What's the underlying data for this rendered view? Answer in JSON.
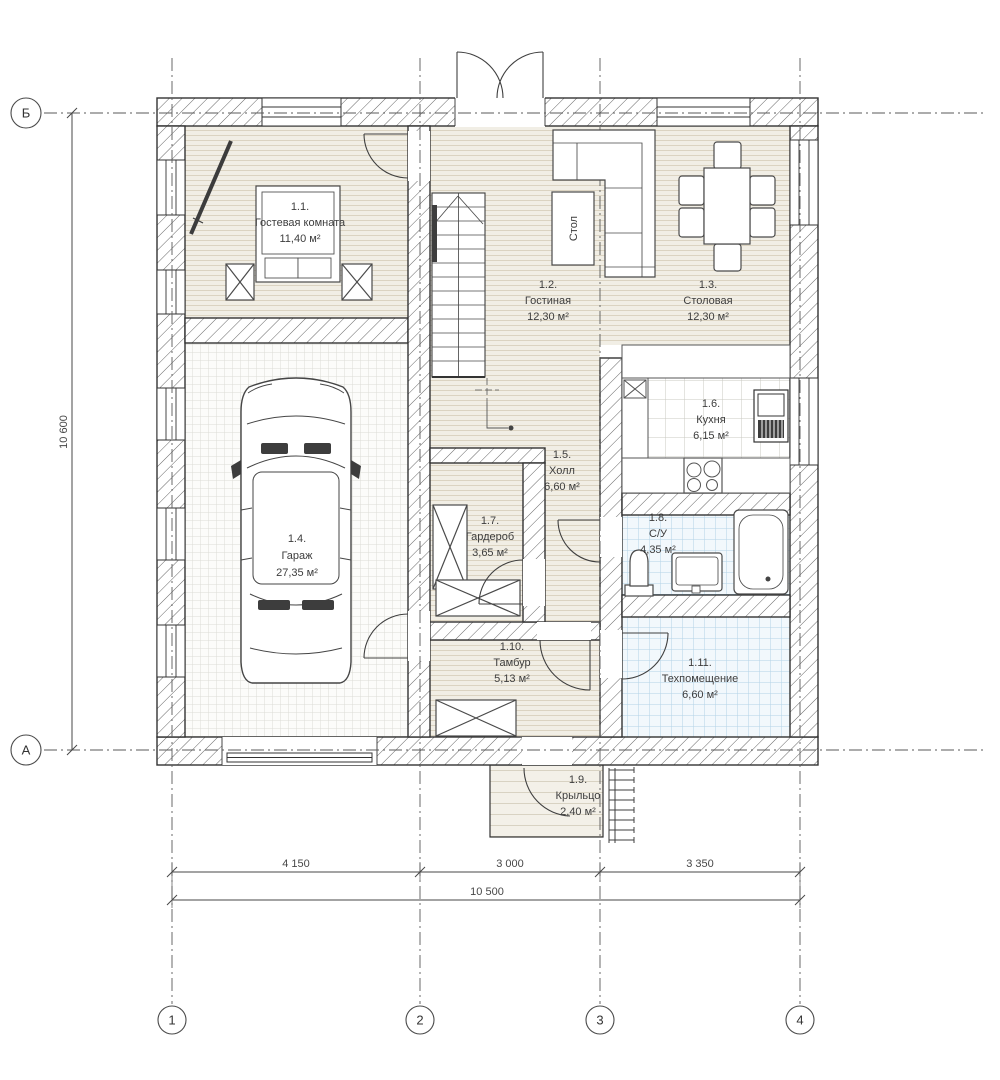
{
  "plan": {
    "rooms": [
      {
        "number": "1.1.",
        "name": "Гостевая комната",
        "area": "11,40 м²"
      },
      {
        "number": "1.2.",
        "name": "Гостиная",
        "area": "12,30 м²"
      },
      {
        "number": "1.3.",
        "name": "Столовая",
        "area": "12,30 м²"
      },
      {
        "number": "1.4.",
        "name": "Гараж",
        "area": "27,35 м²"
      },
      {
        "number": "1.5.",
        "name": "Холл",
        "area": "6,60 м²"
      },
      {
        "number": "1.6.",
        "name": "Кухня",
        "area": "6,15 м²"
      },
      {
        "number": "1.7.",
        "name": "Гардероб",
        "area": "3,65 м²"
      },
      {
        "number": "1.8.",
        "name": "С/У",
        "area": "4,35 м²"
      },
      {
        "number": "1.9.",
        "name": "Крыльцо",
        "area": "2,40 м²"
      },
      {
        "number": "1.10.",
        "name": "Тамбур",
        "area": "5,13 м²"
      },
      {
        "number": "1.11.",
        "name": "Техпомещение",
        "area": "6,60 м²"
      }
    ],
    "furniture_labels": {
      "table": "Стол"
    },
    "grid_axes": {
      "rows": [
        "Б",
        "А"
      ],
      "cols": [
        "1",
        "2",
        "3",
        "4"
      ]
    },
    "dimensions": {
      "vertical_total": "10 600",
      "horizontal_segments": [
        "4 150",
        "3 000",
        "3 350"
      ],
      "horizontal_total": "10 500"
    }
  }
}
